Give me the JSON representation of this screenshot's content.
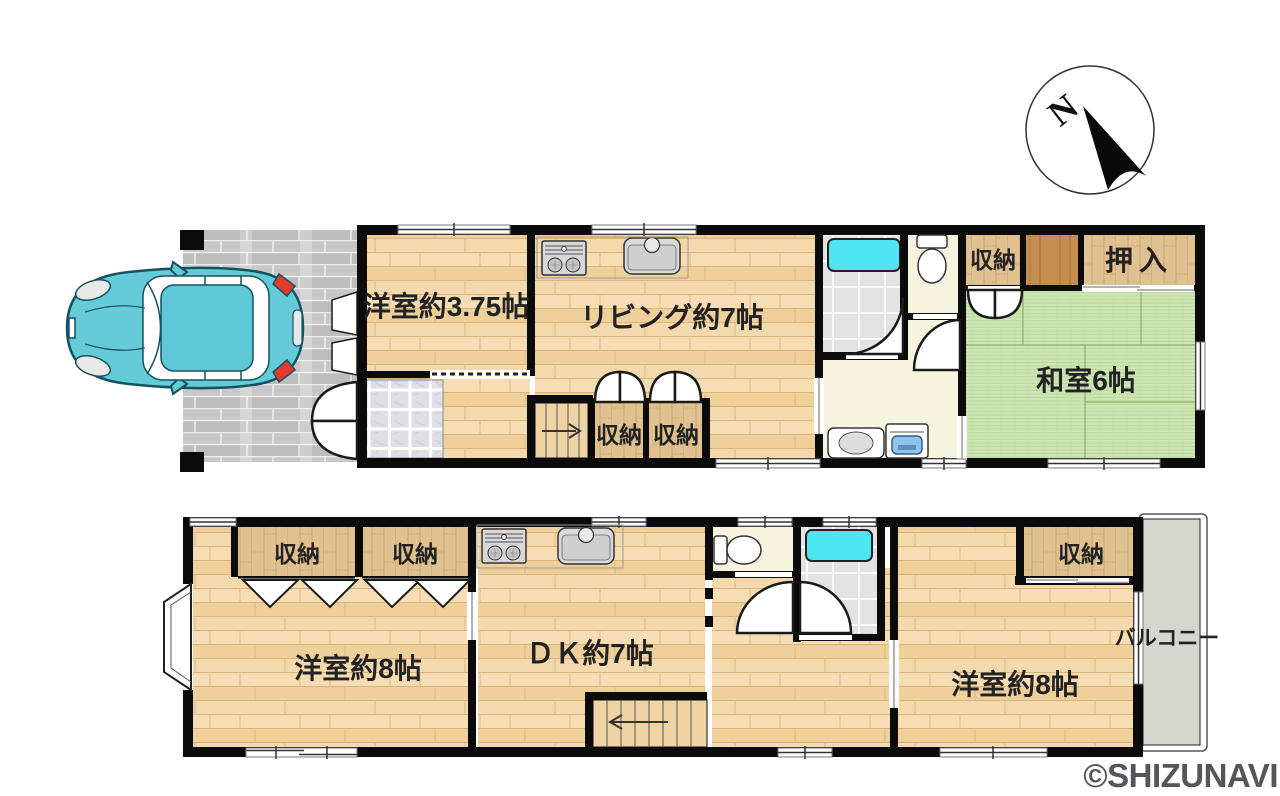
{
  "compass": {
    "north": "N"
  },
  "f1": {
    "west_room": "洋室約3.75帖",
    "living": "リビング約7帖",
    "storage_a": "収納",
    "storage_b": "収納",
    "storage_right": "収納",
    "oshiire": "押入",
    "tatami_room": "和室6帖"
  },
  "f2": {
    "storage_a": "収納",
    "storage_b": "収納",
    "west_room_left": "洋室約8帖",
    "dk": "ＤＫ約7帖",
    "storage_right": "収納",
    "west_room_right": "洋室約8帖",
    "balcony": "バルコニー"
  },
  "watermark": "©SHIZUNAVI",
  "colors": {
    "wood_floor": "#F3D7A7",
    "closet_wood": "#E0C191",
    "dark_wood": "#C48E50",
    "tatami": "#CDE5B3",
    "bathtub": "#4FE5F1",
    "pavement": "#C0C0C0",
    "balcony": "#D6D6D0",
    "car_body": "#66CBD9",
    "wall": "#0B0B0B",
    "hall_floor": "#F6F4DE",
    "watermark_gray": "#55565A"
  }
}
